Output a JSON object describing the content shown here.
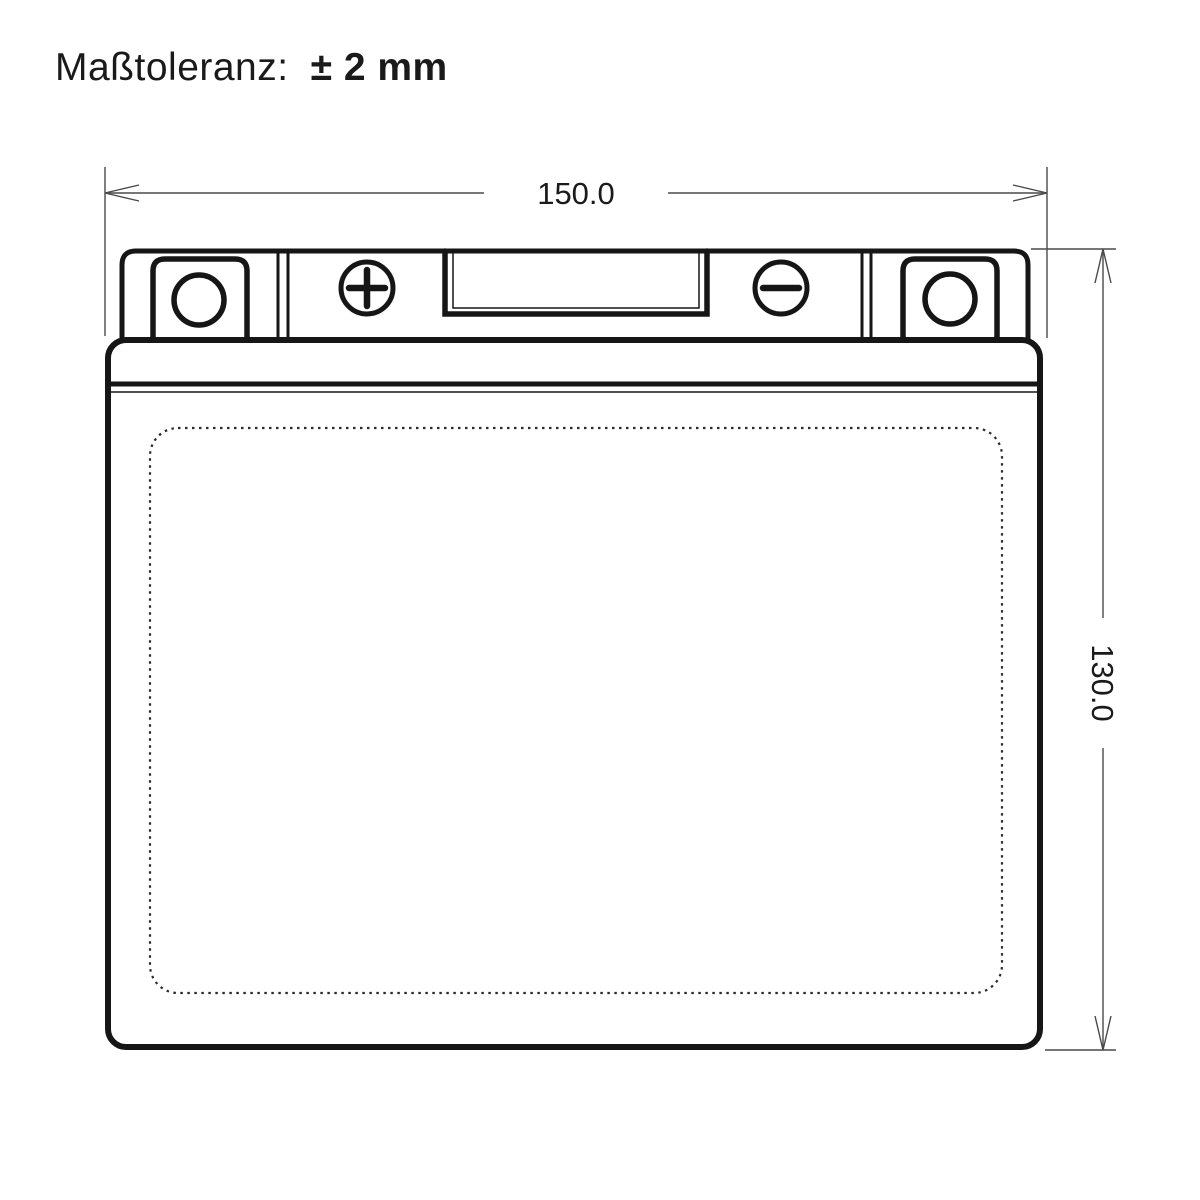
{
  "title": {
    "label": "Maßtoleranz:",
    "value": "± 2 mm"
  },
  "dimensions": {
    "width_label": "150.0",
    "height_label": "130.0"
  },
  "icons": {
    "positive_terminal": "plus-icon",
    "negative_terminal": "minus-icon",
    "arrows": [
      "arrow-left-icon",
      "arrow-right-icon",
      "arrow-up-icon",
      "arrow-down-icon"
    ]
  },
  "colors": {
    "background": "#ffffff",
    "outline": "#161616",
    "dimension": "#4a4a4a",
    "text": "#1a1a1a"
  }
}
